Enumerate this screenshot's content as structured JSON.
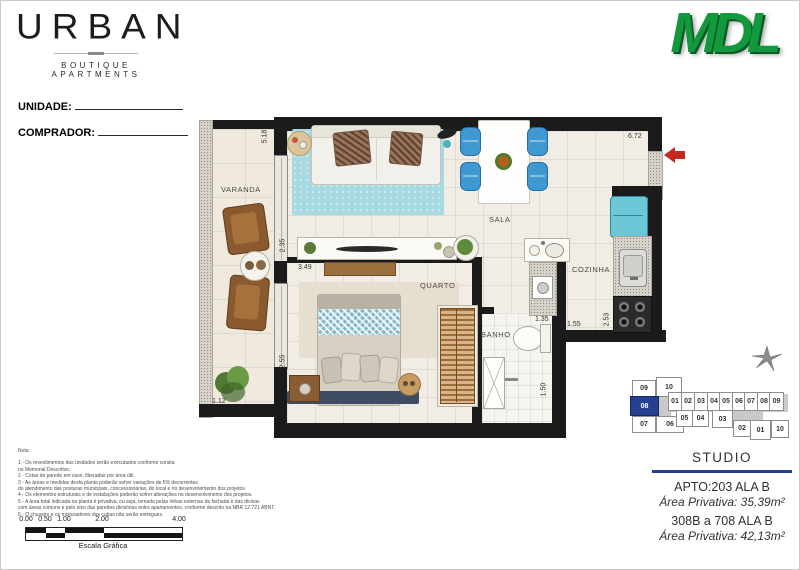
{
  "brand": {
    "logo_text": "URBAN",
    "logo_subtitle": "BOUTIQUE APARTMENTS",
    "developer_logo": "MDL"
  },
  "form": {
    "unit_label": "UNIDADE:",
    "buyer_label": "COMPRADOR:"
  },
  "plan": {
    "rooms": {
      "varanda": "VARANDA",
      "sala": "SALA",
      "quarto": "QUARTO",
      "cozinha": "COZINHA",
      "banho": "BANHO"
    },
    "dims": [
      "5.18",
      "2.35",
      "3.49",
      "2.55",
      "1.12",
      "6.72",
      "1.35",
      "1.55",
      "2.53",
      "1.50"
    ]
  },
  "keyplan": {
    "units": [
      {
        "label": "09"
      },
      {
        "label": "10"
      },
      {
        "label": "08",
        "highlighted": true
      },
      {
        "label": "07"
      },
      {
        "label": "06"
      },
      {
        "label": "01"
      },
      {
        "label": "02"
      },
      {
        "label": "03"
      },
      {
        "label": "04"
      },
      {
        "label": "05"
      },
      {
        "label": "06"
      },
      {
        "label": "07"
      },
      {
        "label": "08"
      },
      {
        "label": "09"
      },
      {
        "label": "05"
      },
      {
        "label": "04"
      },
      {
        "label": "03"
      },
      {
        "label": "02"
      },
      {
        "label": "01"
      },
      {
        "label": "10"
      }
    ]
  },
  "info": {
    "type_title": "STUDIO",
    "apto_line": "APTO:203 ALA B",
    "area_line": "Área Privativa: 35,39m²",
    "range_line": "308B a 708 ALA B",
    "range_area_line": "Área Privativa: 42,13m²"
  },
  "notes": {
    "title": "Nota:",
    "lines": [
      "1 - Os revestimentos das unidades serão executados conforme consta",
      "no Memorial Descritivo.",
      "2 - Cotas de parede em osso, liberadas por área útil.",
      "3 - As áreas e medidas desta planta poderão sofrer variações de 5% decorrentes",
      "do atendimento das posturas municipais, concessionárias, do local e no desenvolvimento dos projetos.",
      "4 - Os elementos estruturais e de instalações poderão sofrer alterações no desenvolvimento dos projetos.",
      "5 - A área total indicada na planta é privativa, ou seja, tomada pelas linhas externas da fachada e das divisas",
      "com áreas comuns e pelo eixo das paredes divisórias entre apartamentos, conforme descrito na NBR 12.721 ABNT.",
      "6 - O chuveiro e os misturadores das cubas não serão entregues."
    ]
  },
  "scale": {
    "labels": [
      "0.00",
      "0.50",
      "1.00",
      "2.00",
      "4.00"
    ],
    "caption": "Escala Gráfica"
  },
  "colors": {
    "mdl_green": "#13993d",
    "keyplan_highlight": "#24418f",
    "info_divider": "#24418f",
    "rug_teal": "#a6d9e2",
    "chair_blue": "#3f98d0",
    "entrance_arrow_red": "#c4281e",
    "wall_black": "#1b1b1b"
  }
}
